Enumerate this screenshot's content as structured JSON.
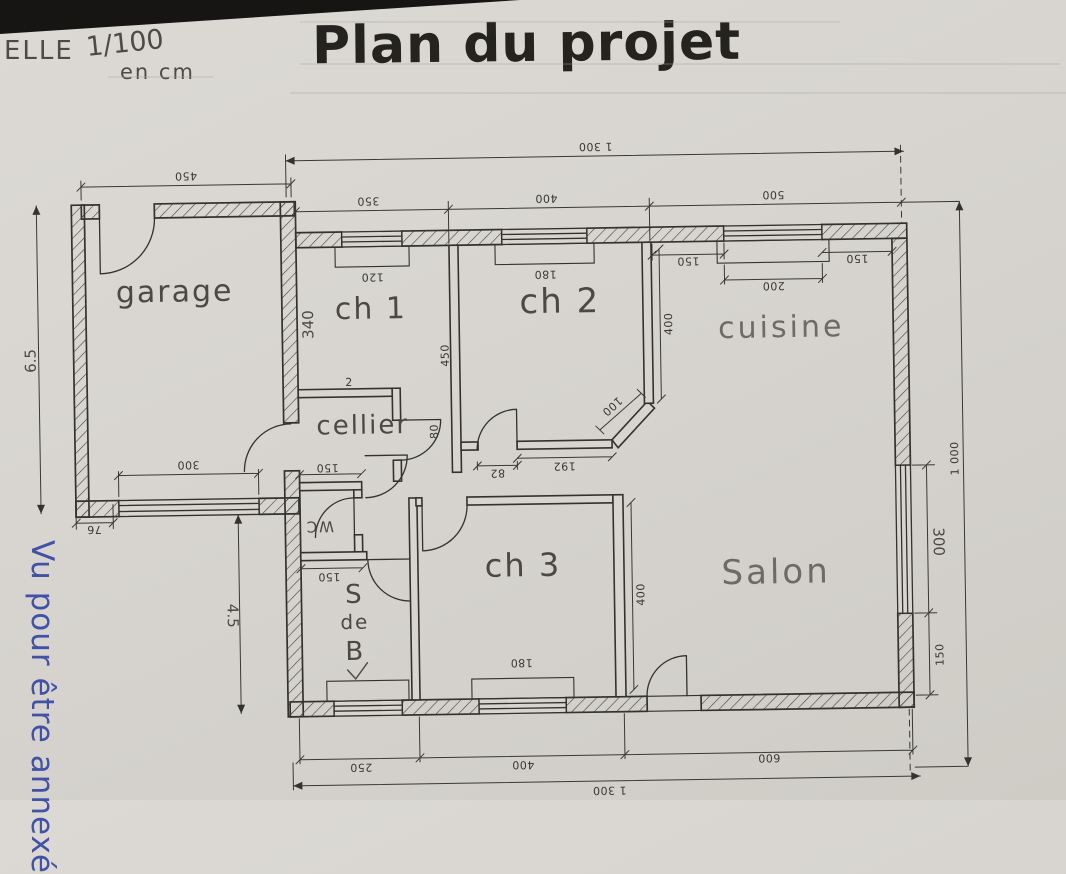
{
  "title": "Plan du projet",
  "scale_note": {
    "prefix": "ELLE",
    "ratio": "1/100",
    "unit": "en cm"
  },
  "stamp": {
    "text": "Vu pour être annexé"
  },
  "rooms": {
    "garage": "garage",
    "ch1": "ch 1",
    "ch2": "ch 2",
    "ch3": "ch 3",
    "cuisine": "cuisine",
    "cellier": "cellier",
    "wc": "WC",
    "salon": "Salon",
    "sdb1": "S",
    "sdb2": "de",
    "sdb3": "B"
  },
  "dims": {
    "top_total": "1 300",
    "top_ch1": "350",
    "top_ch2": "400",
    "top_cuisine": "500",
    "garage_width": "450",
    "garage_height": "6.5",
    "garage_window": "300",
    "garage_pier": "76",
    "yard_height": "4.5",
    "ch1_window": "120",
    "ch2_window": "180",
    "ch1_depth": "340",
    "partition_450": "450",
    "cuisine_gap_left": "150",
    "cuisine_window": "200",
    "cuisine_gap_right": "150",
    "cuisine_wall": "400",
    "entry_splay": "100",
    "door_width": "82",
    "hall_wall": "192",
    "door_80": "80",
    "mark_2": "2",
    "cellier_width": "150",
    "wc_width": "150",
    "ch3_wall": "400",
    "ch3_window": "180",
    "salon_window": "300",
    "salon_pier": "150",
    "right_total": "1 000",
    "bottom_sdb": "250",
    "bottom_ch3": "400",
    "bottom_salon": "600",
    "bottom_total": "1 300"
  },
  "colors": {
    "paper": "#d8d5d1",
    "ink": "#34322e",
    "pencil": "#4e4b47",
    "stamp_blue": "#3448a4",
    "photo_background": "#161513"
  }
}
